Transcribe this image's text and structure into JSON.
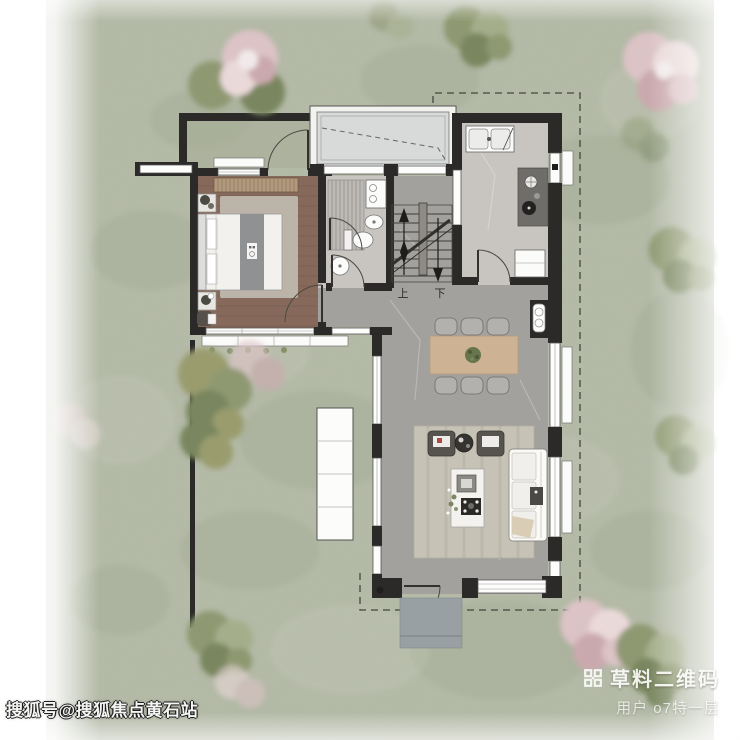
{
  "watermarks": {
    "sohu": "搜狐号@搜狐焦点黄石站",
    "caoliao": {
      "title": "草料二维码",
      "user": "用户 o7特一层"
    }
  },
  "floor_plan": {
    "stairs": {
      "up": "上",
      "down": "下"
    }
  },
  "icons": {
    "qr_icon": "caoliao-qr-grid"
  },
  "colors": {
    "lawn": "#b4baa7",
    "wall": "#2b2a28",
    "wood": "#86695a",
    "marbleLight": "#c8c5c1",
    "marbleDark": "#a3a19e",
    "glass": "#d7dad8",
    "porch": "#98a0a4",
    "rug": "#c6c2b6",
    "tableWood": "#cdb393",
    "treePink": "#dcc3c6",
    "treeGreen": "#8e9871",
    "accentRed": "#b0493f"
  }
}
